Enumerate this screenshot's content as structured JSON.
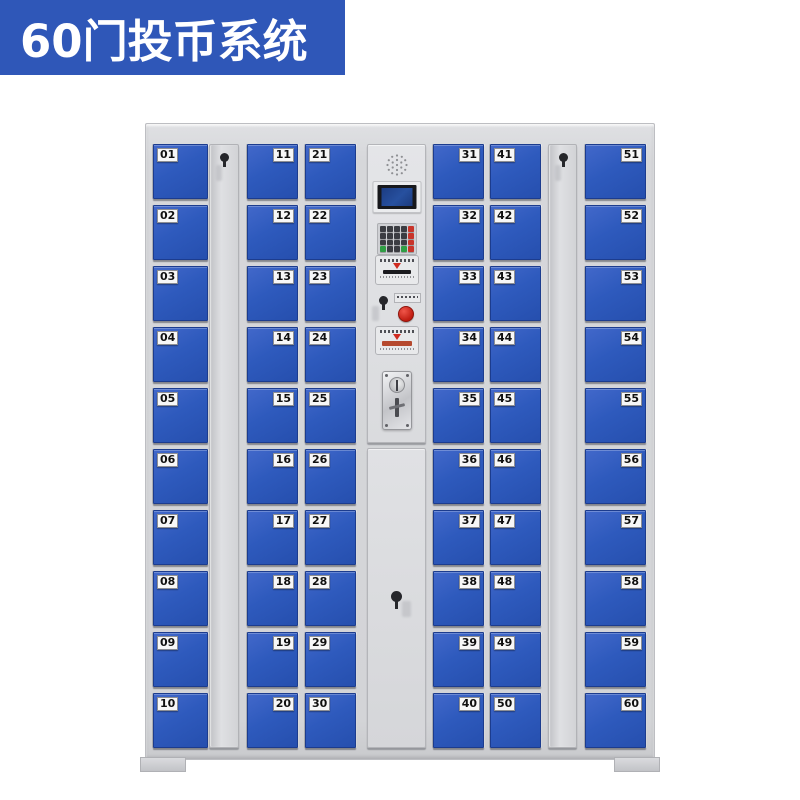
{
  "banner": {
    "title": "60门投币系统"
  },
  "colors": {
    "banner_bg": "#2f57b8",
    "door_blue": "#2e5abd",
    "door_border": "#1c3c8e",
    "label_bg": "#f7f7f7",
    "label_text": "#101010",
    "accent_red": "#c8342a",
    "accent_green": "#2f9e44",
    "screen_blue": "#27509f",
    "cabinet_gray": "#d6d7da"
  },
  "cabinet": {
    "door_columns": [
      {
        "id": "col-1",
        "label_side": "left",
        "doors": [
          "01",
          "02",
          "03",
          "04",
          "05",
          "06",
          "07",
          "08",
          "09",
          "10"
        ]
      },
      {
        "id": "col-2",
        "label_side": "right",
        "doors": [
          "11",
          "12",
          "13",
          "14",
          "15",
          "16",
          "17",
          "18",
          "19",
          "20"
        ]
      },
      {
        "id": "col-3",
        "label_side": "left",
        "doors": [
          "21",
          "22",
          "23",
          "24",
          "25",
          "26",
          "27",
          "28",
          "29",
          "30"
        ]
      },
      {
        "id": "col-4",
        "label_side": "right",
        "doors": [
          "31",
          "32",
          "33",
          "34",
          "35",
          "36",
          "37",
          "38",
          "39",
          "40"
        ]
      },
      {
        "id": "col-5",
        "label_side": "left",
        "doors": [
          "41",
          "42",
          "43",
          "44",
          "45",
          "46",
          "47",
          "48",
          "49",
          "50"
        ]
      },
      {
        "id": "col-6",
        "label_side": "right",
        "doors": [
          "51",
          "52",
          "53",
          "54",
          "55",
          "56",
          "57",
          "58",
          "59",
          "60"
        ]
      }
    ],
    "side_lock_panels": 2,
    "control_panel": {
      "elements": [
        "speaker-grill",
        "lcd-display",
        "numeric-keypad",
        "card-reader-slot",
        "key-lock",
        "red-button",
        "instruction-sticker",
        "coin-acceptor",
        "service-door-lock"
      ],
      "keypad": {
        "rows": [
          [
            "k",
            "k",
            "k",
            "k",
            "r"
          ],
          [
            "k",
            "k",
            "k",
            "k",
            "r"
          ],
          [
            "k",
            "k",
            "k",
            "k",
            "r"
          ],
          [
            "g",
            "k",
            "k",
            "g",
            "r"
          ]
        ]
      }
    }
  }
}
